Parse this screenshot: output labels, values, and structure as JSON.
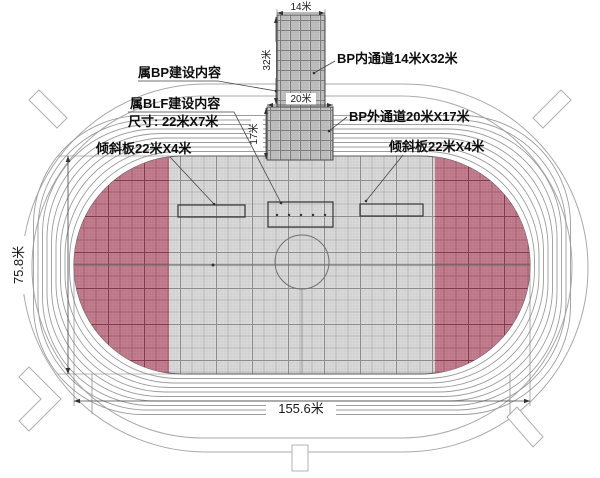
{
  "labels": {
    "belongs_bp": "属BP建设内容",
    "belongs_blf": "属BLF建设内容",
    "blf_size": "尺寸: 22米X7米",
    "tilt_board_left": "倾斜板22米X4米",
    "tilt_board_right": "倾斜板22米X4米",
    "bp_inner_channel": "BP内通道14米X32米",
    "bp_outer_channel": "BP外通道20米X17米"
  },
  "dimensions": {
    "inner_channel_width": "14米",
    "inner_channel_length": "32米",
    "outer_channel_width": "20米",
    "outer_channel_length": "17米",
    "field_height": "75.8米",
    "track_width": "155.6米"
  },
  "colors": {
    "red_bg": "#c58292",
    "red_thin": "#b26b7d",
    "red_mid": "#9a4f64",
    "red_dark": "#83394e",
    "gray_bg": "#dcdcdc",
    "gray_thin": "#c8c8c8",
    "gray_mid": "#ababab",
    "gray_dark": "#8c8c8c",
    "cor_bg": "#d2d2d2",
    "cor_v": "#9a9a9a",
    "cor_h": "#b4b4b4",
    "cor_dark": "#7d7d7d",
    "fence": "#a9a9a9",
    "lane": "#9c9c9c",
    "outline": "#5a5a5a"
  }
}
